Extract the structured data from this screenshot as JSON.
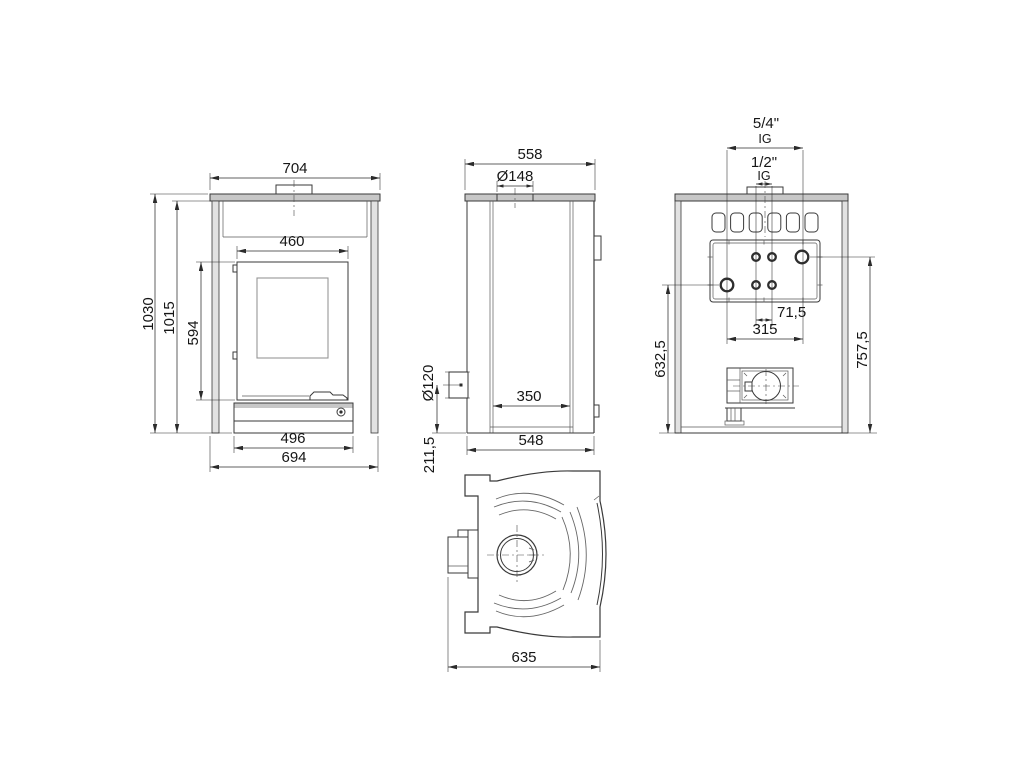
{
  "page": {
    "background": "#ffffff",
    "line_color": "#3a3a3a"
  },
  "views": {
    "front": {
      "name": "front view",
      "dims": {
        "plate_width": "704",
        "door_width": "460",
        "overall_height": "1030",
        "body_height": "1015",
        "door_height": "594",
        "plinth_width": "496",
        "body_width": "694"
      }
    },
    "side": {
      "name": "side view",
      "dims": {
        "plate_depth": "558",
        "flue_collar_diameter": "Ø148",
        "rear_flue_diameter": "Ø120",
        "rear_flue_center_height": "211,5",
        "plinth_depth": "350",
        "body_depth": "548"
      }
    },
    "back": {
      "name": "back view",
      "dims": {
        "boiler_connection_size": "5/4\"",
        "boiler_connection_thread": "IG",
        "drain_connection_size": "1/2\"",
        "drain_connection_thread": "IG",
        "drain_spacing": "71,5",
        "boiler_connection_spacing": "315",
        "return_height": "632,5",
        "supply_height": "757,5"
      }
    },
    "top": {
      "name": "top view",
      "dims": {
        "overall_depth": "635"
      }
    }
  }
}
